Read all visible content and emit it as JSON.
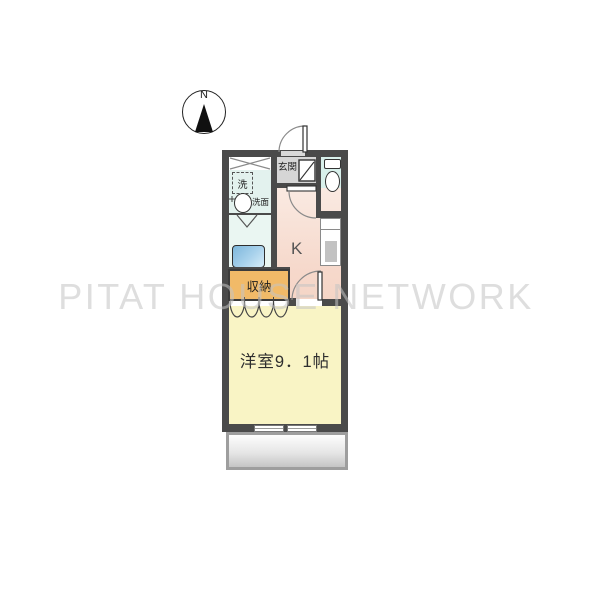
{
  "watermark": {
    "text": "PITAT HOUSE NETWORK"
  },
  "compass": {
    "label": "N"
  },
  "floorplan": {
    "entrance": {
      "label": "玄関"
    },
    "washer": {
      "label": "洗"
    },
    "washbasin": {
      "label": "洗面"
    },
    "kitchen": {
      "label": "K"
    },
    "storage": {
      "label": "収納"
    },
    "main_room": {
      "label": "洋室9．1帖",
      "type": "洋室",
      "size_jo": "9.1"
    },
    "fixtures": [
      "toilet",
      "bathtub",
      "washbasin",
      "washing-machine-space",
      "kitchen-counter",
      "shoe-cabinet",
      "balcony",
      "sliding-window",
      "entrance-door",
      "interior-doors",
      "folding-closet-doors"
    ]
  },
  "colors": {
    "wall": "#4a4a4a",
    "kitchen": "#f6d9cc",
    "main_room": "#f9f4c5",
    "storage": "#f1ba68",
    "toilet_room": "#d8f0eb",
    "washroom": "#e3f2ee",
    "bathroom": "#eaf6f2",
    "bathtub": "#7db7dc",
    "entrance_floor": "#d6d6d6",
    "balcony_frame": "#9e9e9e",
    "watermark_gray": "#c4c4c4"
  }
}
